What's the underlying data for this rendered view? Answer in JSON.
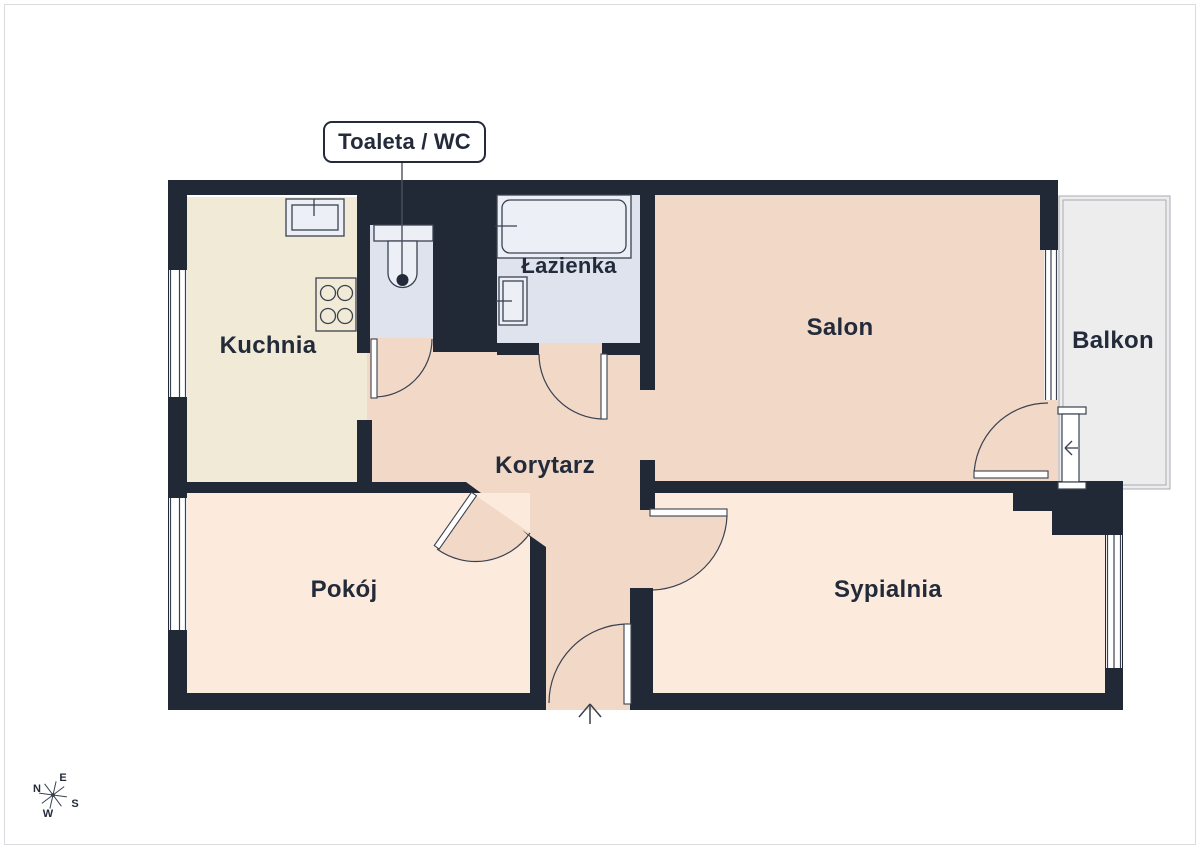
{
  "callout": {
    "label": "Toaleta / WC"
  },
  "rooms": {
    "kuchnia": {
      "label": "Kuchnia"
    },
    "lazienka": {
      "label": "Łazienka"
    },
    "salon": {
      "label": "Salon"
    },
    "balkon": {
      "label": "Balkon"
    },
    "korytarz": {
      "label": "Korytarz"
    },
    "pokoj": {
      "label": "Pokój"
    },
    "sypialnia": {
      "label": "Sypialnia"
    }
  },
  "compass": {
    "n": "N",
    "e": "E",
    "s": "S",
    "w": "W"
  },
  "icons": {
    "toilet": "toilet-fixture",
    "bathtub": "bathtub-fixture",
    "bathroom_sink": "bathroom-sink-fixture",
    "kitchen_sink": "kitchen-sink-fixture",
    "stove": "stove-burners-fixture",
    "balcony_radiator": "balcony-radiator-fixture",
    "compass_rose": "compass-rose-icon",
    "entrance_arrow": "entrance-arrow-icon"
  },
  "colors": {
    "wall": "#212936",
    "floor_warm": "#f2d9c7",
    "floor_cream": "#f0ead6",
    "floor_light": "#fcebdc",
    "floor_cool": "#dee3ee",
    "floor_balcony": "#ededed",
    "fixture": "#edeff6",
    "line": "#3a4150",
    "text": "#232b3a",
    "page_border": "#d9dbde",
    "bg": "#ffffff"
  }
}
